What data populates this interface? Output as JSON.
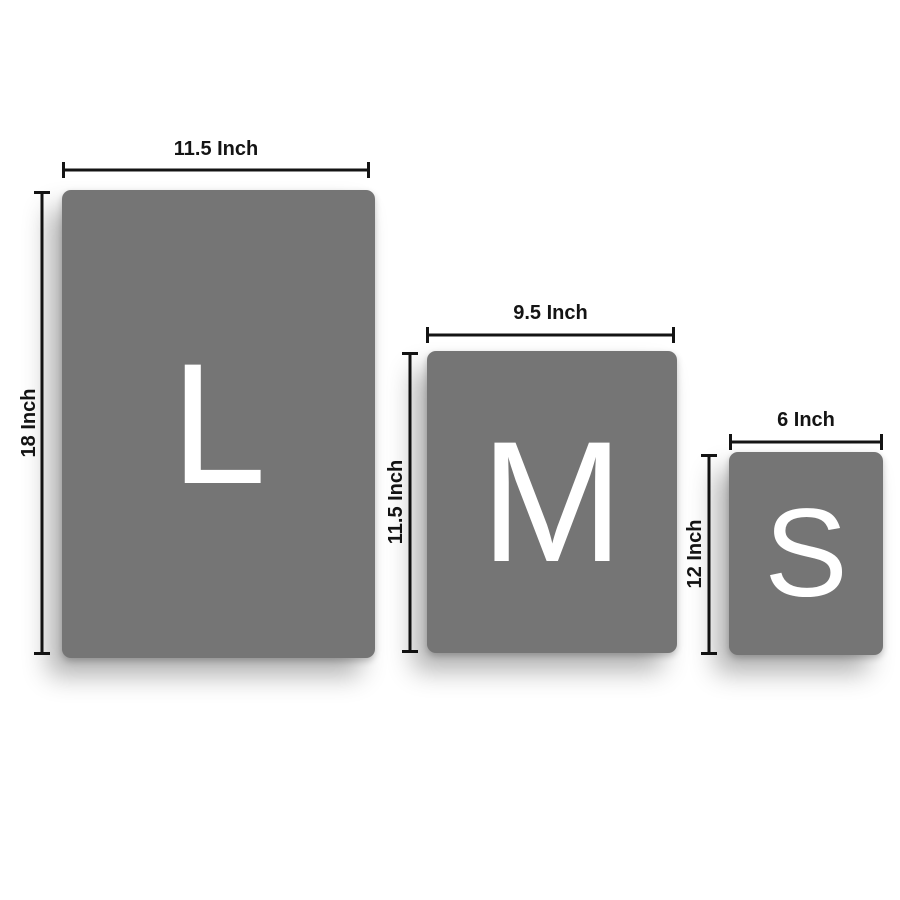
{
  "diagram": {
    "sizes": [
      {
        "code": "L",
        "name": "large",
        "width_label": "11.5 Inch",
        "height_label": "18 Inch"
      },
      {
        "code": "M",
        "name": "medium",
        "width_label": "9.5 Inch",
        "height_label": "11.5 Inch"
      },
      {
        "code": "S",
        "name": "small",
        "width_label": "6 Inch",
        "height_label": "12 Inch"
      }
    ],
    "colors": {
      "panel": "#757575",
      "letter": "#ffffff",
      "dimension_line": "#141414",
      "background": "#ffffff"
    }
  }
}
